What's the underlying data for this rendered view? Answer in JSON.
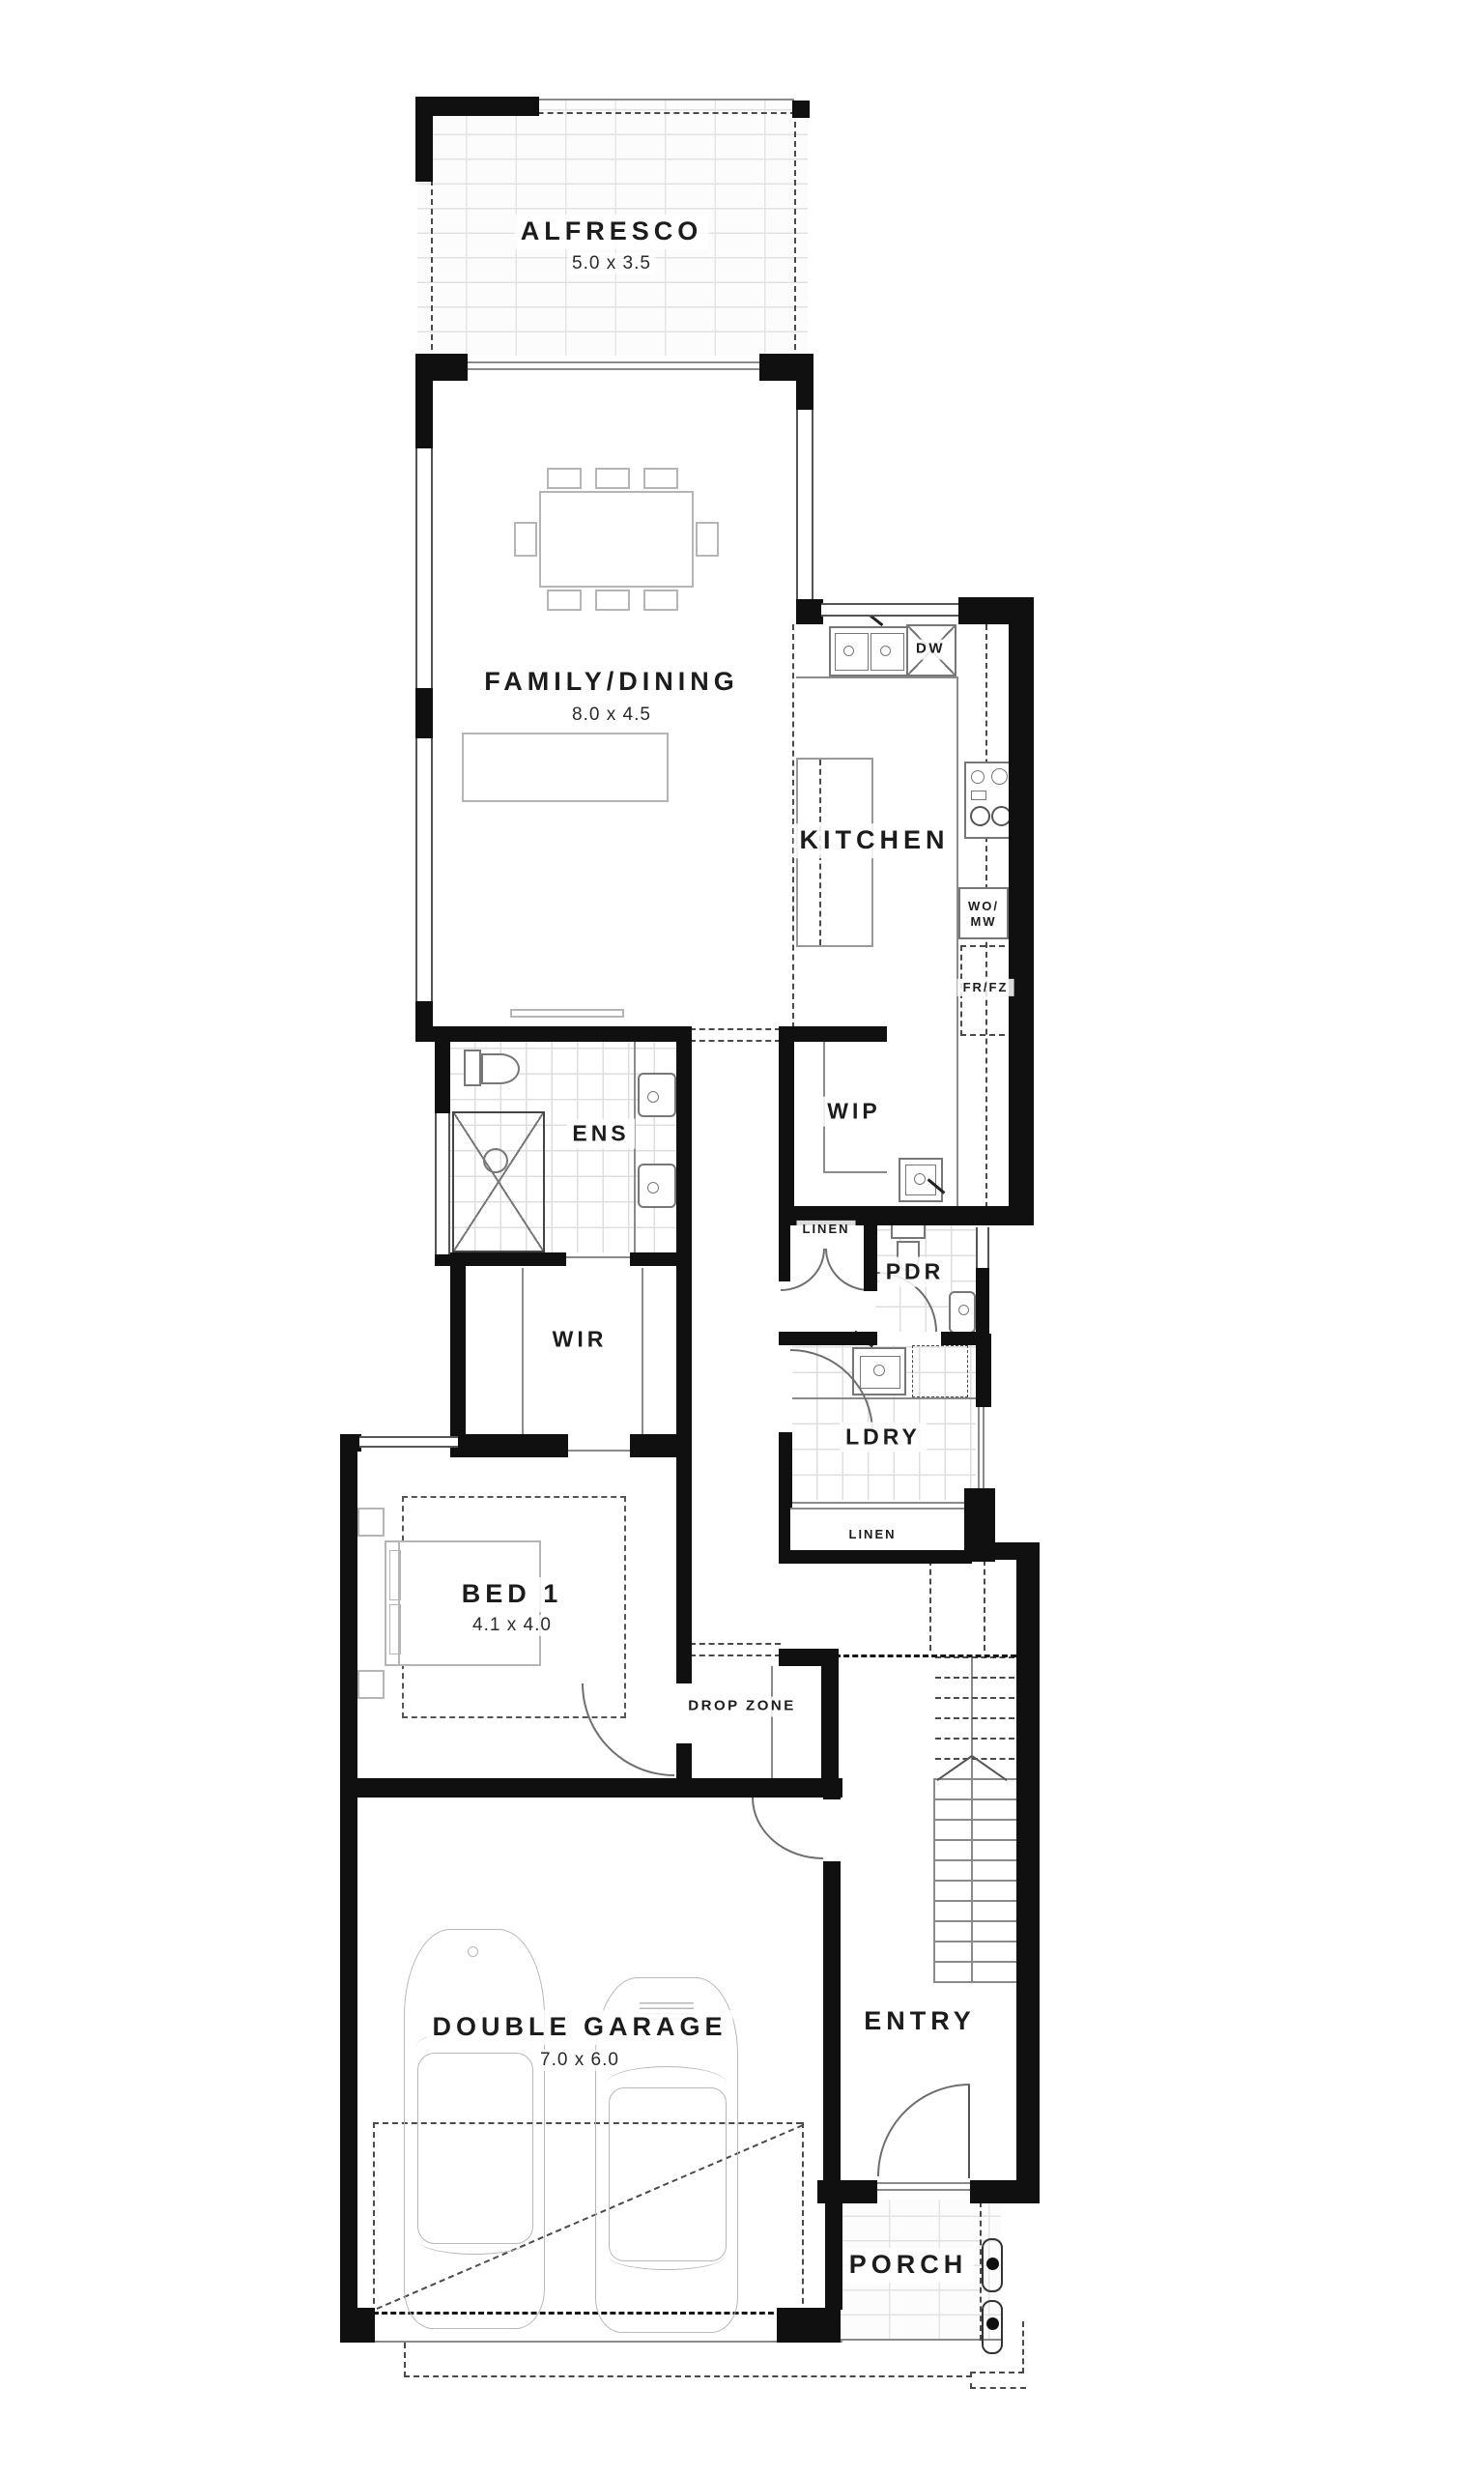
{
  "rooms": {
    "alfresco": {
      "name": "ALFRESCO",
      "dim": "5.0 x 3.5"
    },
    "family_dining": {
      "name": "FAMILY/DINING",
      "dim": "8.0 x 4.5"
    },
    "kitchen": {
      "name": "KITCHEN"
    },
    "wip": {
      "name": "WIP"
    },
    "ens": {
      "name": "ENS"
    },
    "wir": {
      "name": "WIR"
    },
    "linen_upper": {
      "name": "LINEN"
    },
    "pdr": {
      "name": "PDR"
    },
    "ldry": {
      "name": "LDRY"
    },
    "linen_lower": {
      "name": "LINEN"
    },
    "bed1": {
      "name": "BED 1",
      "dim": "4.1 x 4.0"
    },
    "drop_zone": {
      "name": "DROP ZONE"
    },
    "entry": {
      "name": "ENTRY"
    },
    "garage": {
      "name": "DOUBLE GARAGE",
      "dim": "7.0 x 6.0"
    },
    "porch": {
      "name": "PORCH"
    }
  },
  "appliances": {
    "dishwasher": "DW",
    "wall_oven_microwave": "WO/\nMW",
    "fridge_freezer": "FR/FZ"
  },
  "colors": {
    "wall": "#101010",
    "line": "#8a8a8a",
    "label": "#1c1c1c"
  }
}
